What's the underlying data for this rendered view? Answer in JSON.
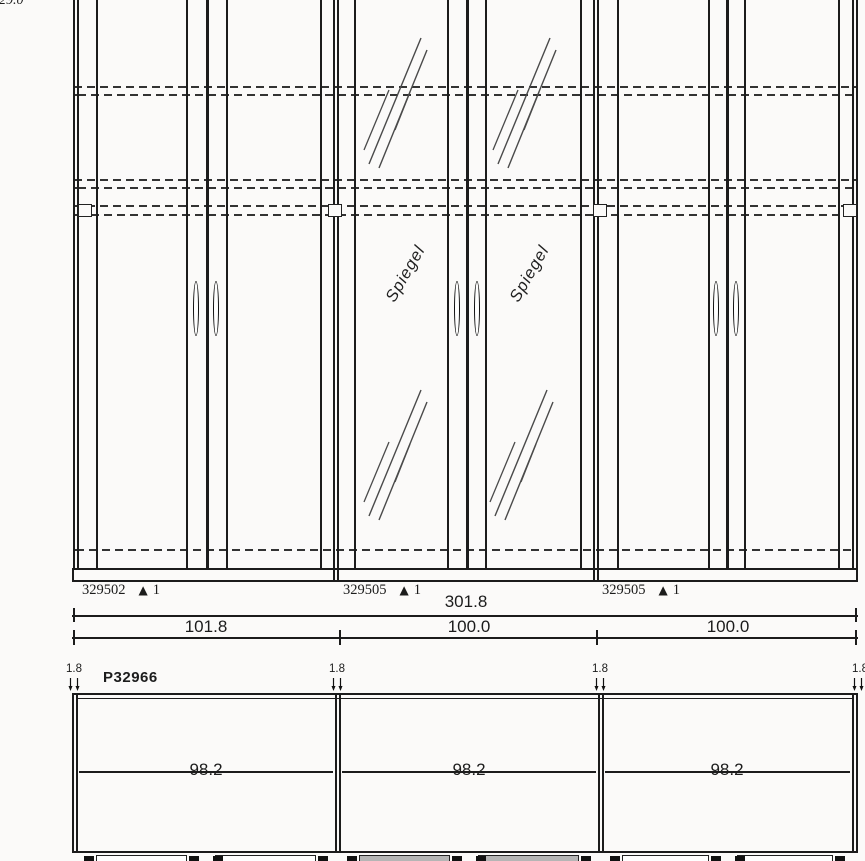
{
  "drawing": {
    "top_left_dim": "29.0",
    "mirror_label": "Spiegel",
    "icons": {
      "triangle_marker": "▲"
    },
    "part_labels": [
      {
        "code": "329502",
        "qty": "1"
      },
      {
        "code": "329505",
        "qty": "1"
      },
      {
        "code": "329505",
        "qty": "1"
      }
    ],
    "overall_width": "301.8",
    "segment_widths": [
      "101.8",
      "100.0",
      "100.0"
    ],
    "plan": {
      "product_code": "P32966",
      "panel_thickness": [
        "1.8",
        "1.8",
        "1.8",
        "1.8"
      ],
      "inner_widths": [
        "98.2",
        "98.2",
        "98.2"
      ]
    },
    "colors": {
      "line": "#1c1c1c",
      "hidden_line": "#333333",
      "mirror_fill": "#b5b5b5",
      "background": "#fbfaf9"
    }
  }
}
